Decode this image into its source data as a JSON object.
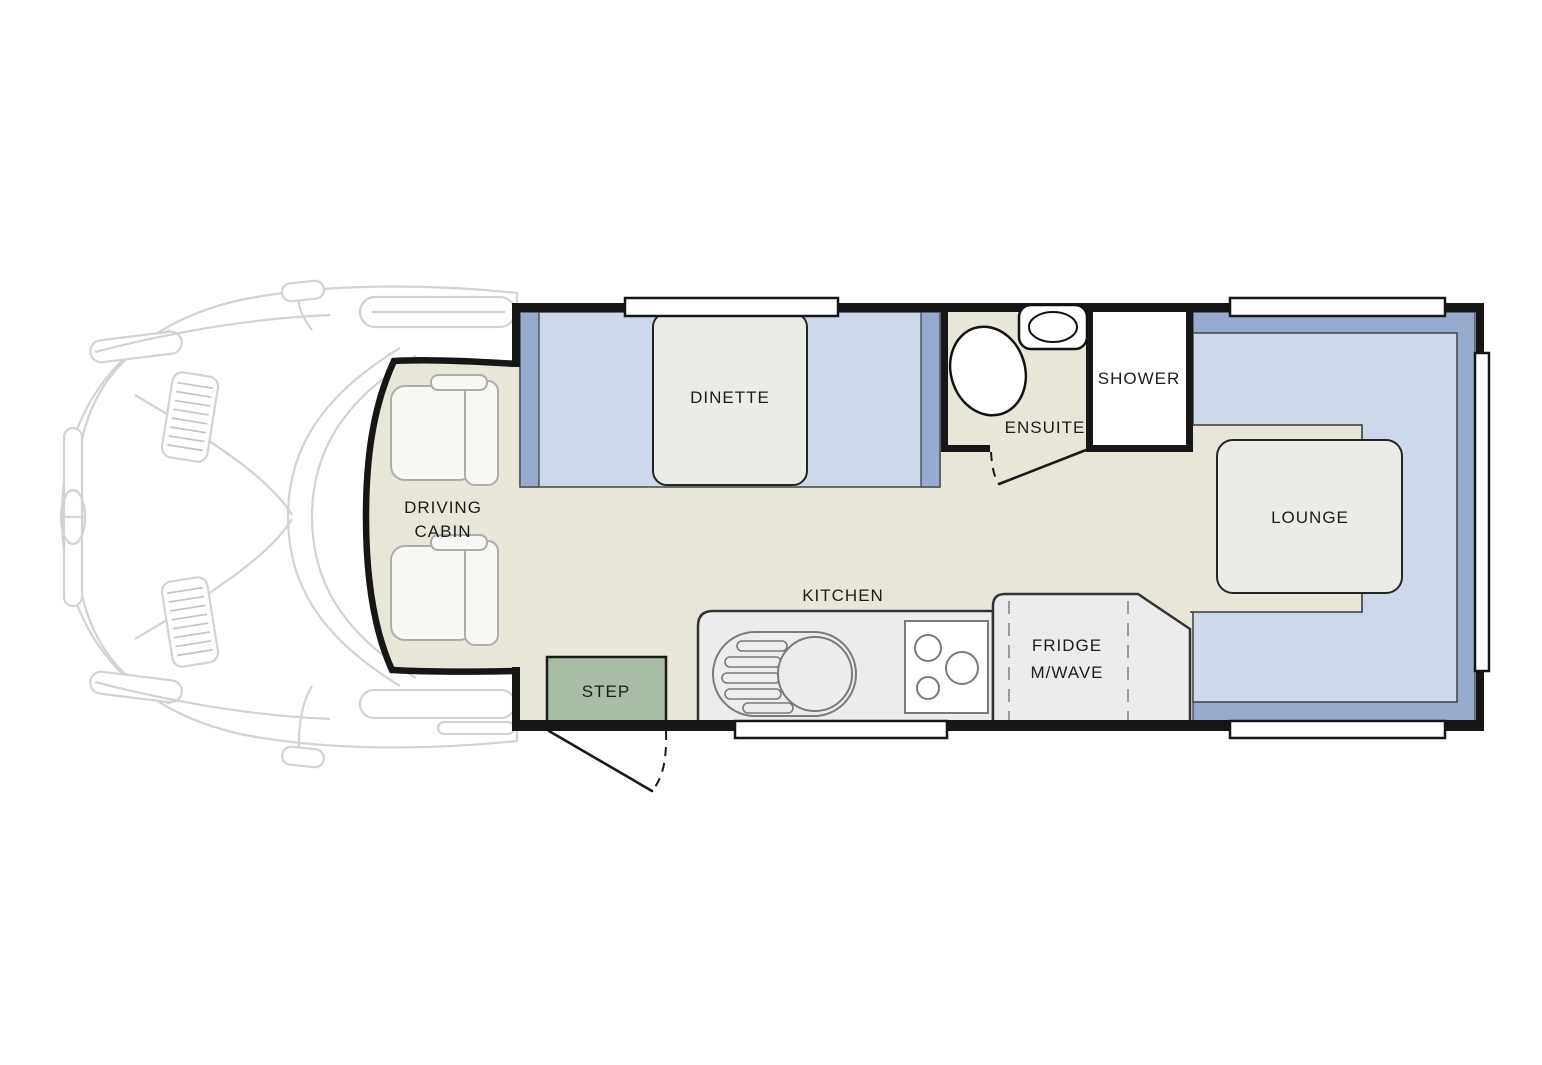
{
  "colors": {
    "background": "#ffffff",
    "wall": "#161616",
    "white": "#ffffff",
    "floor": "#e7e6d9",
    "bench_light": "#cdd9eb",
    "bench_dark": "#96abce",
    "table": "#ecece6",
    "counter": "#ececec",
    "step": "#a9bda6",
    "appliance_outline": "#7a7a7a",
    "divider": "#999999",
    "thin_outline": "#3a3a3a",
    "vehicle_line": "#d2d2d2",
    "vehicle_hatch": "#c6c6c6",
    "label": "#1c1c1c"
  },
  "labels": {
    "dinette": "DINETTE",
    "ensuite": "ENSUITE",
    "shower": "SHOWER",
    "lounge": "LOUNGE",
    "kitchen": "KITCHEN",
    "fridge_line1": "FRIDGE",
    "fridge_line2": "M/WAVE",
    "step": "STEP",
    "driving_cabin_line1": "DRIVING",
    "driving_cabin_line2": "CABIN"
  }
}
